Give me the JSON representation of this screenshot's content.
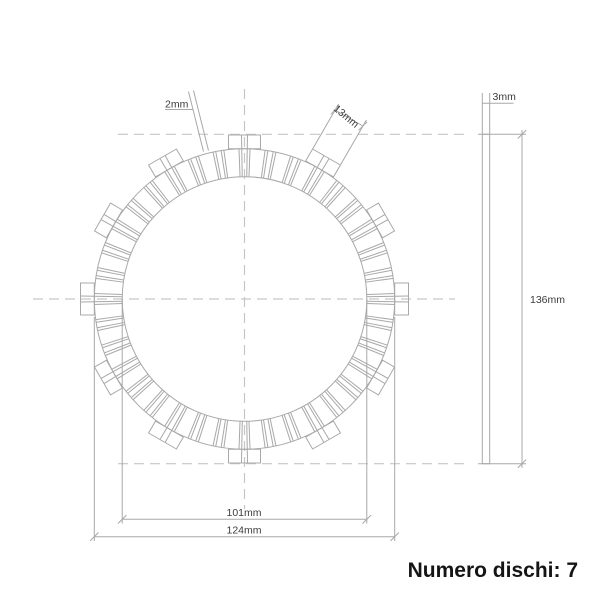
{
  "footer": {
    "text": "Numero dischi: 7",
    "disc_count": 7
  },
  "labels": {
    "gap_width": "2mm",
    "tab_width": "13mm",
    "thickness": "3mm",
    "overall_diameter": "136mm",
    "inner_diameter": "101mm",
    "friction_outer_diameter": "124mm"
  },
  "dimensions_mm": {
    "tooth_gap": 2,
    "tab_width": 13,
    "plate_thickness": 3,
    "overall_outer_diameter": 136,
    "friction_ring_inner_diameter": 101,
    "friction_ring_outer_diameter": 124
  },
  "drawing": {
    "front_view": {
      "center": {
        "x": 244.5,
        "y": 299
      },
      "radius_inner": 122.3,
      "radius_friction_outer": 150.2,
      "radius_tab_outer": 164,
      "teeth_count": 36,
      "tooth_pitch_deg": 10,
      "tab_count": 12,
      "tab_pitch_deg": 30,
      "tab_half_width_px": 16,
      "gap_half_angle_deg": 1.05,
      "chamfer_half_angle_deg": 2.1
    },
    "side_view": {
      "left": 482.3,
      "right": 489.7,
      "top": 134.3,
      "bottom": 463.7
    },
    "colors": {
      "line": "#a8a8a8",
      "dash": "#c6c6c6",
      "dim_text": "#3c3c3c",
      "footer_text": "#151515",
      "background": "#ffffff"
    }
  }
}
